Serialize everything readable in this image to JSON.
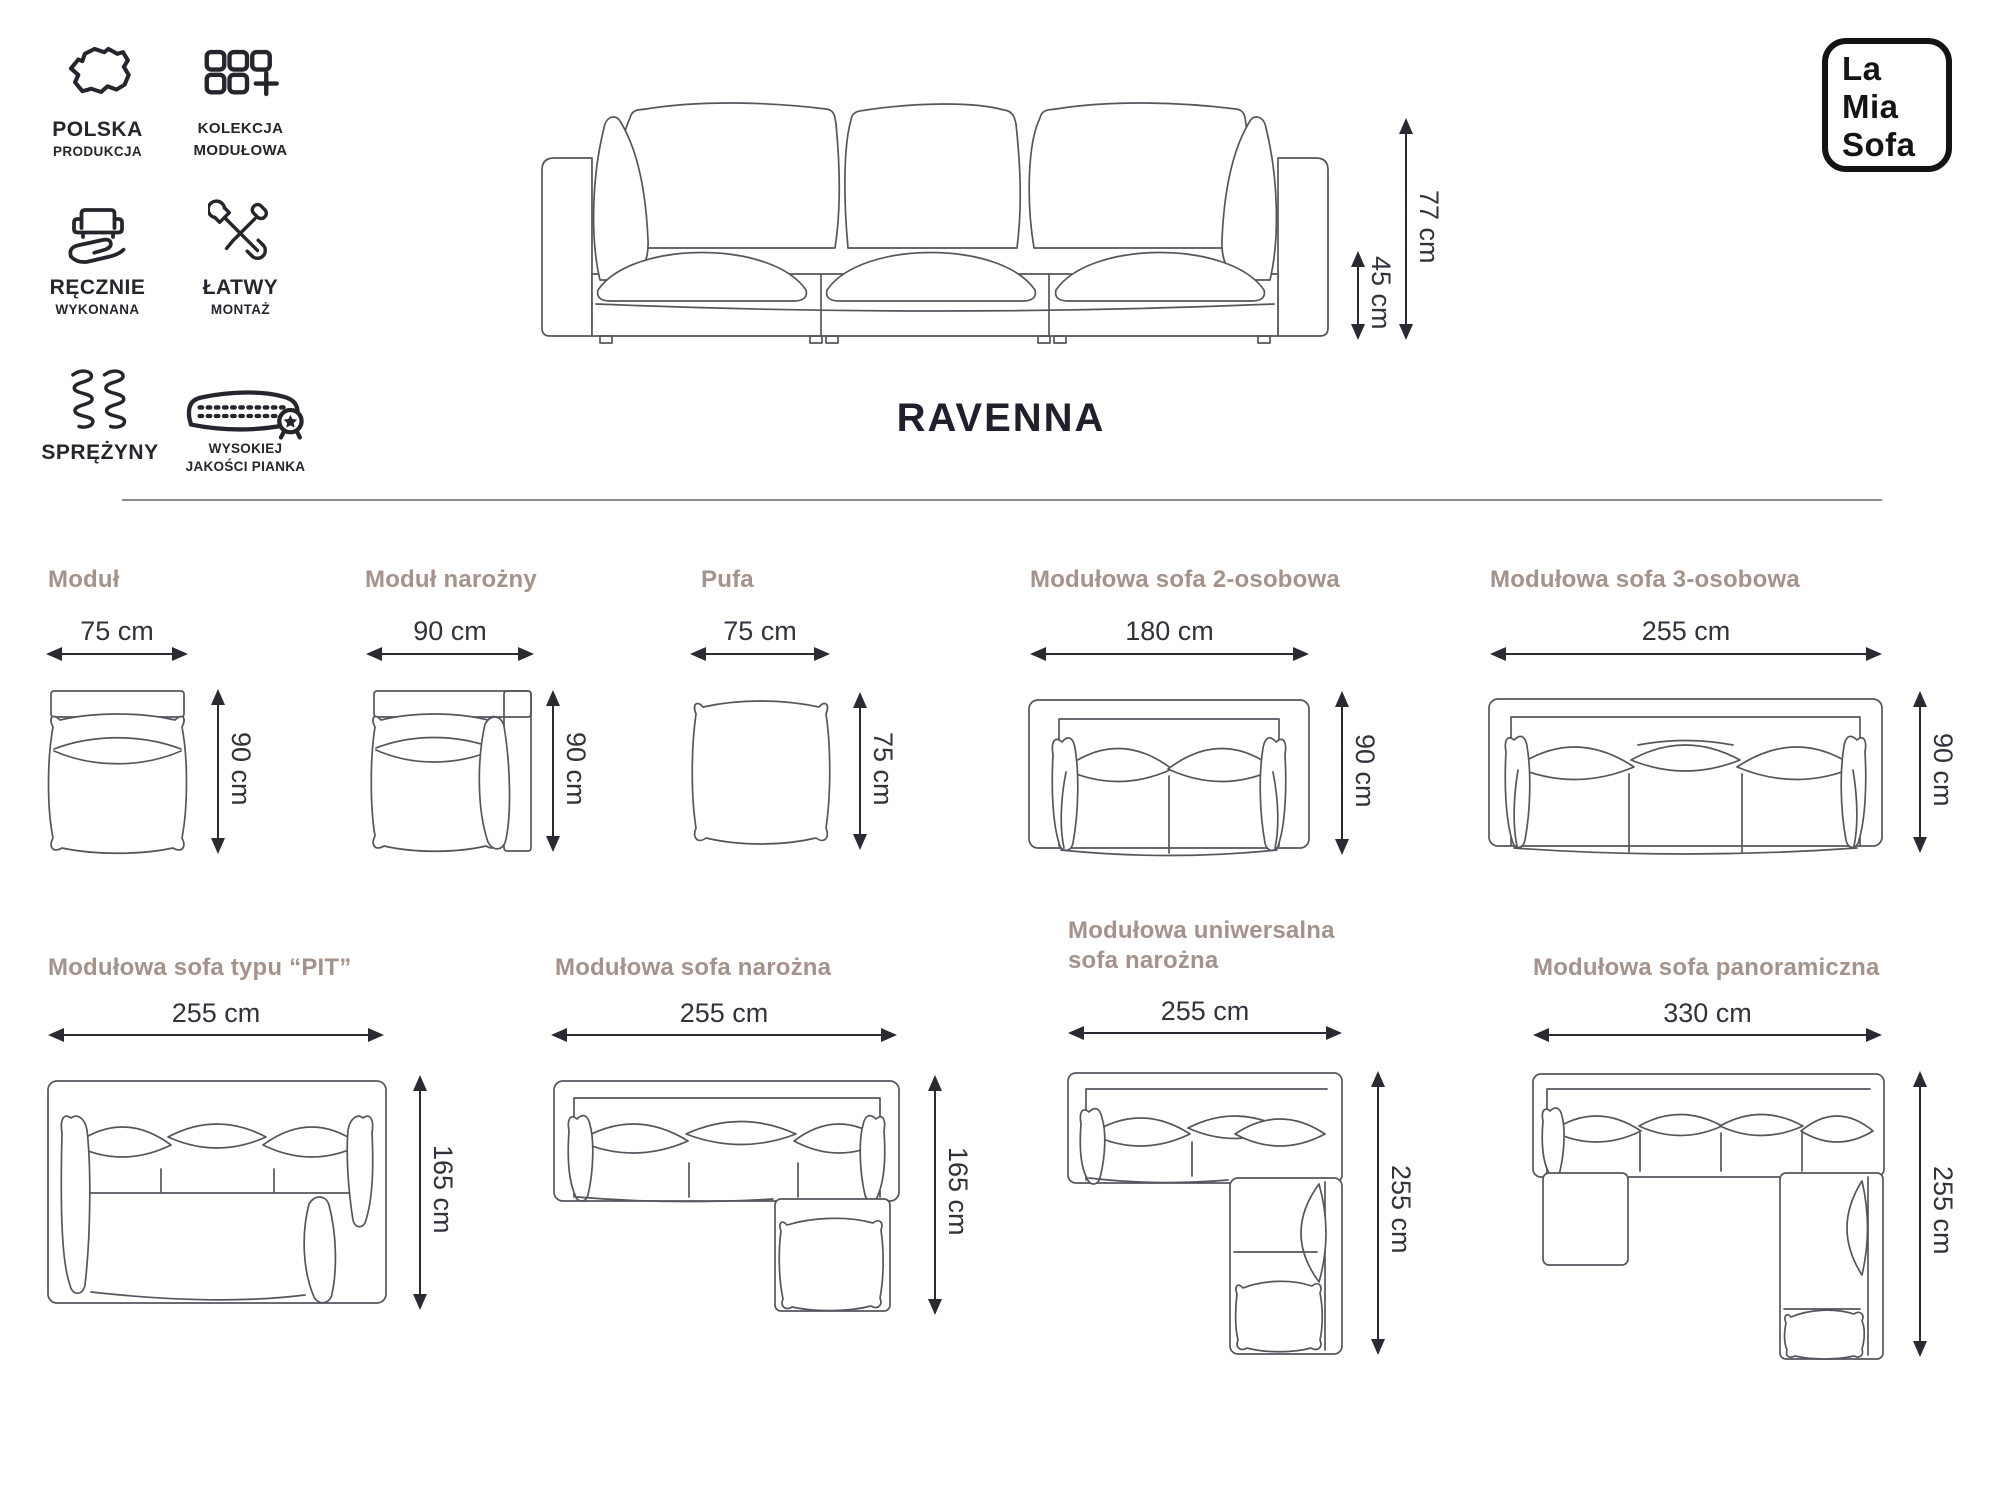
{
  "brand": {
    "name_lines": [
      "La",
      "Mia",
      "Sofa"
    ]
  },
  "product": {
    "name": "RAVENNA",
    "overall_height": "77 cm",
    "seat_height": "45 cm"
  },
  "features": [
    {
      "id": "poland",
      "line1": "POLSKA",
      "line2": "PRODUKCJA",
      "icon": "poland-map-icon"
    },
    {
      "id": "collection",
      "line1": "KOLEKCJA",
      "line2": "MODUŁOWA",
      "icon": "module-grid-icon"
    },
    {
      "id": "handmade",
      "line1": "RĘCZNIE",
      "line2": "WYKONANA",
      "icon": "hand-sofa-icon"
    },
    {
      "id": "assembly",
      "line1": "ŁATWY",
      "line2": "MONTAŻ",
      "icon": "tools-icon"
    },
    {
      "id": "springs",
      "line1": "SPRĘŻYNY",
      "line2": "",
      "icon": "springs-icon"
    },
    {
      "id": "foam",
      "line1": "WYSOKIEJ",
      "line2": "JAKOŚCI PIANKA",
      "icon": "foam-quality-icon"
    }
  ],
  "modules": [
    {
      "name": "Moduł",
      "width": "75 cm",
      "height": "90 cm"
    },
    {
      "name": "Moduł narożny",
      "width": "90 cm",
      "height": "90 cm"
    },
    {
      "name": "Pufa",
      "width": "75 cm",
      "height": "75 cm"
    },
    {
      "name": "Modułowa sofa 2-osobowa",
      "width": "180 cm",
      "height": "90 cm"
    },
    {
      "name": "Modułowa sofa 3-osobowa",
      "width": "255 cm",
      "height": "90 cm"
    },
    {
      "name": "Modułowa sofa typu “PIT”",
      "width": "255 cm",
      "height": "165 cm"
    },
    {
      "name": "Modułowa sofa narożna",
      "width": "255 cm",
      "height": "165 cm"
    },
    {
      "name": "Modułowa uniwersalna sofa narożna",
      "width": "255 cm",
      "height": "255 cm"
    },
    {
      "name": "Modułowa sofa panoramiczna",
      "width": "330 cm",
      "height": "255 cm"
    }
  ],
  "colors": {
    "accent_title": "#a3938a",
    "ink": "#26252d",
    "sketch": "#56555e",
    "dim_text": "#33323c",
    "divider": "#8d8d8d"
  }
}
